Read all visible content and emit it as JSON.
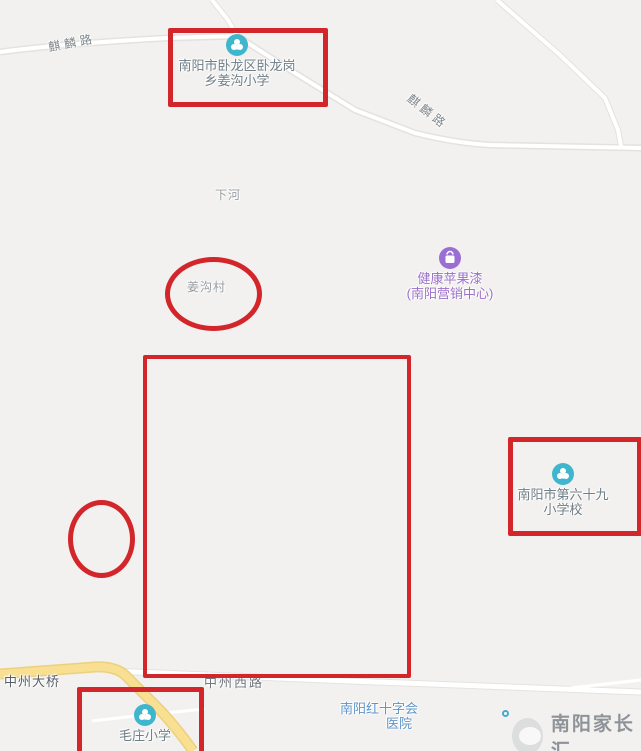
{
  "colors": {
    "annotation_red": "#d2262b",
    "school_icon_teal": "#3fb6cd",
    "shop_icon_purple": "#9a6fd4",
    "hospital_text_blue": "#5f94c8",
    "major_road_yellow": "#f8dd90",
    "map_background": "#f2f1ef"
  },
  "roads": {
    "qilin_west_label": "麒麟路",
    "qilin_diagonal_label": "麒麟路",
    "zhongzhou_bridge_label": "中州大桥",
    "zhongzhou_west_label": "中州西路"
  },
  "areas": {
    "xiahe_label": "下河",
    "jianggou_village_label": "姜沟村"
  },
  "pois": {
    "jianggou_school": {
      "icon": "school-poi-icon",
      "line1": "南阳市卧龙区卧龙岗",
      "line2": "乡姜沟小学"
    },
    "apple_paint": {
      "icon": "shopping-bag-icon",
      "line1": "健康苹果漆",
      "line2": "(南阳营销中心)"
    },
    "school_69": {
      "icon": "school-poi-icon",
      "line1": "南阳市第六十九",
      "line2": "小学校"
    },
    "maozhuang_school": {
      "icon": "school-poi-icon",
      "name": "毛庄小学"
    },
    "red_cross_hospital": {
      "icon": "poi-dot",
      "line1": "南阳红十字会",
      "line2": "医院"
    }
  },
  "annotations": {
    "shapes": [
      "rect-around-jianggou-school",
      "rect-large-empty-area",
      "rect-around-school-69",
      "rect-around-maozhuang-school",
      "ellipse-around-jianggou-village",
      "ellipse-small-left"
    ]
  },
  "watermark": {
    "text": "南阳家长汇"
  }
}
